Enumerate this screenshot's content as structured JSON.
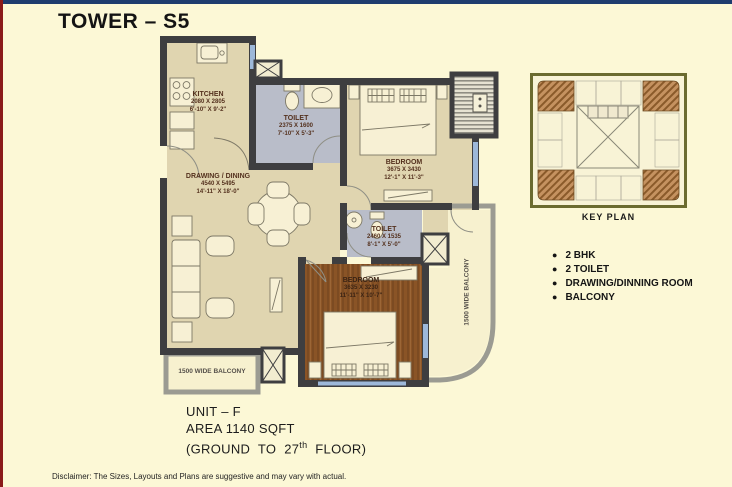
{
  "title": "TOWER – S5",
  "plan": {
    "rooms": {
      "kitchen": {
        "name": "KITCHEN",
        "mm": "2080 X 2805",
        "ft": "6'-10\" X 9'-2\""
      },
      "toilet1": {
        "name": "TOILET",
        "mm": "2375 X 1600",
        "ft": "7'-10\" X 5'-3\""
      },
      "bedroom1": {
        "name": "BEDROOM",
        "mm": "3675 X 3430",
        "ft": "12'-1\" X 11'-3\""
      },
      "drawing_dining": {
        "name": "DRAWING / DINING",
        "mm": "4540 X 5495",
        "ft": "14'-11\" X 18'-0\""
      },
      "toilet2": {
        "name": "TOILET",
        "mm": "2460 X 1535",
        "ft": "8'-1\" X 5'-0\""
      },
      "bedroom2": {
        "name": "BEDROOM",
        "mm": "3635 X 3230",
        "ft": "11'-11\" X 10'-7\""
      },
      "balcony_bottom": {
        "name": "1500 WIDE BALCONY"
      },
      "balcony_right": {
        "name": "1500 WIDE BALCONY"
      }
    }
  },
  "key_plan": {
    "label": "KEY PLAN"
  },
  "features": {
    "bullet": "●",
    "items": [
      "2 BHK",
      "2 TOILET",
      "DRAWING/DINNING ROOM",
      "BALCONY"
    ]
  },
  "unit_info": {
    "unit": "UNIT – F",
    "area": "AREA 1140 SQFT",
    "floors_prefix": "(GROUND TO 27",
    "floors_sup": "th",
    "floors_suffix": " FLOOR)"
  },
  "disclaimer": "Disclaimer:  The Sizes, Layouts and Plans are suggestive and may vary with actual.",
  "colors": {
    "top_strip": "#1e3c6e",
    "left_strip": "#8a1a1a",
    "background": "#fcf8d6",
    "wall": "#3e3e40",
    "floor": "#e0d5b0",
    "toilet_floor": "#b9bdc9",
    "wood_floor": "#8a5426",
    "window": "#9db8d9",
    "balcony_floor": "#f7f1cf",
    "keyplan_border": "#6b6b2f",
    "keyplan_highlight": "#b07a3f"
  }
}
